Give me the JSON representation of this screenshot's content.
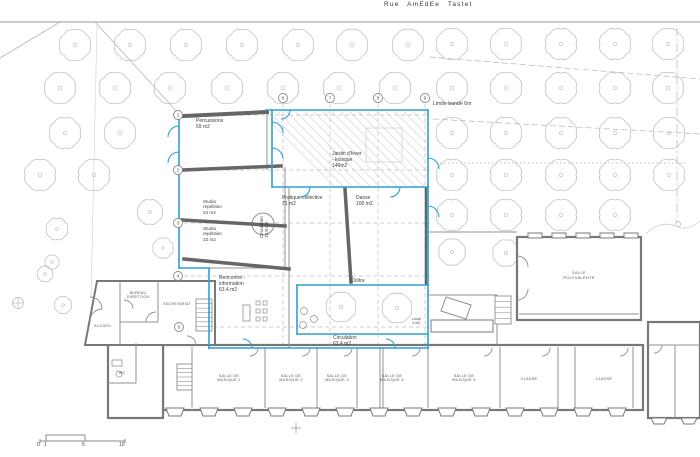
{
  "street": {
    "label": "Rue AmEdEe Tastet"
  },
  "colors": {
    "blue": "#2e9fd6",
    "wall": "#666666",
    "bldg": "#787878",
    "inner": "#909090",
    "door": "#8f8f8f",
    "thin": "#b5b5b5",
    "faint": "#d0d0d0",
    "road": "#9a9a9a",
    "dash": "#bdbdbd",
    "tree": "#c3c9c9",
    "text": "#3e3e3e",
    "marker": "#8a8a8a"
  },
  "labels": [
    {
      "name": "street-name",
      "text": "Rue AmEdEe Tastet",
      "x": 384,
      "y": 1,
      "size": 6.5,
      "cls": "street"
    },
    {
      "name": "limite-label",
      "text": "Limite bande 6m",
      "x": 433,
      "y": 101,
      "size": 5.2,
      "cls": ""
    },
    {
      "name": "room-percussions",
      "text": "Percussions\n59 m2",
      "x": 196,
      "y": 119,
      "size": 5,
      "cls": ""
    },
    {
      "name": "room-jardin-hiver",
      "text": "Jardin d'hiver\n- kiosque\n146m2",
      "x": 332,
      "y": 152,
      "size": 5,
      "cls": ""
    },
    {
      "name": "room-pratique-collective",
      "text": "Pratique collective\n71 m2",
      "x": 282,
      "y": 196,
      "size": 5,
      "cls": ""
    },
    {
      "name": "room-danse",
      "text": "Danse\n100 m2",
      "x": 356,
      "y": 196,
      "size": 5,
      "cls": ""
    },
    {
      "name": "room-studio-1",
      "text": "Studio\nrépétition\n23 m2",
      "x": 203,
      "y": 199,
      "size": 4.6,
      "cls": ""
    },
    {
      "name": "room-studio-2",
      "text": "Studio\nrépétition\n23 m2",
      "x": 203,
      "y": 226,
      "size": 4.6,
      "cls": ""
    },
    {
      "name": "room-circulation-vertical",
      "text": "Circulation\n13.8 m2",
      "x": 259,
      "y": 238,
      "size": 4.6,
      "cls": "vert"
    },
    {
      "name": "room-rencontre",
      "text": "Rencontre -\ninformation\n63.4 m2",
      "x": 219,
      "y": 276,
      "size": 5,
      "cls": ""
    },
    {
      "name": "room-cloitre",
      "text": "Cloître",
      "x": 350,
      "y": 279,
      "size": 5,
      "cls": ""
    },
    {
      "name": "room-circulation-bas",
      "text": "Circulation\n63.4 m2",
      "x": 333,
      "y": 336,
      "size": 5,
      "cls": ""
    },
    {
      "name": "room-bureau-direction",
      "text": "BUREAU\nDIRECTION",
      "x": 138,
      "y": 291,
      "size": 3.6,
      "cls": "caps center"
    },
    {
      "name": "room-secretariat",
      "text": "SECRETARIAT",
      "x": 177,
      "y": 302,
      "size": 3.6,
      "cls": "caps center"
    },
    {
      "name": "room-accueil",
      "text": "ACCUEIL",
      "x": 103,
      "y": 324,
      "size": 3.6,
      "cls": "caps center"
    },
    {
      "name": "room-wc",
      "text": "WC",
      "x": 122,
      "y": 371,
      "size": 3.6,
      "cls": "caps center"
    },
    {
      "name": "room-salle-polyvalente",
      "text": "SALLE\nPOLYVALENTE",
      "x": 579,
      "y": 271,
      "size": 4,
      "cls": "caps center"
    },
    {
      "name": "room-salle-musique-1",
      "text": "SALLE DE\nMUSIQUE 1",
      "x": 229,
      "y": 374,
      "size": 3.8,
      "cls": "caps center"
    },
    {
      "name": "room-salle-musique-2",
      "text": "SALLE DE\nMUSIQUE 2",
      "x": 291,
      "y": 374,
      "size": 3.8,
      "cls": "caps center"
    },
    {
      "name": "room-salle-musique-3",
      "text": "SALLE DE\nMUSIQUE 3",
      "x": 337,
      "y": 374,
      "size": 3.8,
      "cls": "caps center"
    },
    {
      "name": "room-salle-musique-4",
      "text": "SALLE DE\nMUSIQUE 4",
      "x": 392,
      "y": 374,
      "size": 3.8,
      "cls": "caps center"
    },
    {
      "name": "room-salle-musique-5",
      "text": "SALLE DE\nMUSIQUE 5",
      "x": 464,
      "y": 374,
      "size": 3.8,
      "cls": "caps center"
    },
    {
      "name": "room-classe-1",
      "text": "CLASSE",
      "x": 529,
      "y": 377,
      "size": 3.8,
      "cls": "caps center"
    },
    {
      "name": "room-classe-2",
      "text": "CLASSE",
      "x": 604,
      "y": 377,
      "size": 3.8,
      "cls": "caps center"
    },
    {
      "name": "room-local",
      "text": "Local\n4 m2",
      "x": 412,
      "y": 317,
      "size": 3.6,
      "cls": ""
    },
    {
      "name": "scale-0",
      "text": "0",
      "x": 37,
      "y": 443,
      "size": 5,
      "cls": ""
    },
    {
      "name": "scale-1",
      "text": "1",
      "x": 44,
      "y": 443,
      "size": 5,
      "cls": ""
    },
    {
      "name": "scale-5",
      "text": "5",
      "x": 82,
      "y": 443,
      "size": 5,
      "cls": ""
    },
    {
      "name": "scale-10",
      "text": "10",
      "x": 119,
      "y": 443,
      "size": 5,
      "cls": ""
    }
  ],
  "grid_markers": [
    {
      "n": "1",
      "x": 178,
      "y": 115
    },
    {
      "n": "2",
      "x": 178,
      "y": 170
    },
    {
      "n": "3",
      "x": 178,
      "y": 223
    },
    {
      "n": "4",
      "x": 178,
      "y": 276
    },
    {
      "n": "5",
      "x": 179,
      "y": 327
    },
    {
      "n": "6",
      "x": 283,
      "y": 98
    },
    {
      "n": "7",
      "x": 330,
      "y": 98
    },
    {
      "n": "8",
      "x": 378,
      "y": 98
    },
    {
      "n": "9",
      "x": 425,
      "y": 98
    }
  ],
  "trees": [
    [
      75,
      45
    ],
    [
      130,
      45
    ],
    [
      186,
      45
    ],
    [
      242,
      45
    ],
    [
      298,
      45
    ],
    [
      352,
      45
    ],
    [
      408,
      45
    ],
    [
      452,
      44
    ],
    [
      506,
      44
    ],
    [
      561,
      44
    ],
    [
      615,
      44
    ],
    [
      668,
      44
    ],
    [
      60,
      88
    ],
    [
      115,
      88
    ],
    [
      170,
      88
    ],
    [
      227,
      88
    ],
    [
      283,
      88
    ],
    [
      339,
      88
    ],
    [
      395,
      88
    ],
    [
      452,
      88
    ],
    [
      506,
      88
    ],
    [
      561,
      88
    ],
    [
      615,
      88
    ],
    [
      668,
      88
    ],
    [
      65,
      133
    ],
    [
      120,
      133
    ],
    [
      452,
      133
    ],
    [
      506,
      133
    ],
    [
      561,
      133
    ],
    [
      615,
      133
    ],
    [
      669,
      133
    ],
    [
      40,
      175
    ],
    [
      94,
      175
    ],
    [
      452,
      175
    ],
    [
      506,
      175
    ],
    [
      561,
      175
    ],
    [
      615,
      175
    ],
    [
      669,
      175
    ],
    [
      452,
      215
    ],
    [
      506,
      215
    ],
    [
      561,
      215
    ],
    [
      615,
      215
    ],
    [
      150,
      212,
      16
    ],
    [
      57,
      229,
      14
    ],
    [
      163,
      248,
      13
    ],
    [
      45,
      274,
      10
    ],
    [
      341,
      307,
      19
    ],
    [
      397,
      308,
      19
    ],
    [
      452,
      252,
      17
    ],
    [
      506,
      253,
      17
    ],
    [
      52,
      262,
      9
    ],
    [
      63,
      305,
      11
    ]
  ],
  "geometry": {
    "lines": [
      [
        0,
        22,
        700,
        22,
        0.9,
        "road",
        ""
      ],
      [
        95,
        22,
        179,
        114,
        0.8,
        "thin",
        ""
      ],
      [
        60,
        22,
        0,
        58,
        0.8,
        "thin",
        ""
      ],
      [
        97,
        24,
        91,
        298,
        0.6,
        "faint",
        ""
      ],
      [
        430,
        57,
        700,
        79,
        0.7,
        "thin",
        "6 3"
      ],
      [
        433,
        119,
        700,
        134,
        0.7,
        "thin",
        "6 3"
      ],
      [
        440,
        163,
        688,
        163,
        1,
        "dash",
        "1.5 2.5"
      ],
      [
        677,
        28,
        677,
        222,
        0.7,
        "thin",
        "8 3 2 3"
      ],
      [
        184,
        115,
        430,
        115,
        0.7,
        "dash",
        "4 3"
      ],
      [
        184,
        170,
        430,
        170,
        0.7,
        "dash",
        "4 3"
      ],
      [
        184,
        223,
        430,
        223,
        0.7,
        "dash",
        "4 3"
      ],
      [
        184,
        276,
        430,
        276,
        0.7,
        "dash",
        "4 3"
      ],
      [
        185,
        327,
        430,
        327,
        0.7,
        "dash",
        "4 3"
      ],
      [
        283,
        104,
        283,
        352,
        0.7,
        "dash",
        "4 3"
      ],
      [
        330,
        104,
        330,
        352,
        0.7,
        "dash",
        "4 3"
      ],
      [
        378,
        104,
        378,
        352,
        0.7,
        "dash",
        "4 3"
      ],
      [
        425,
        104,
        425,
        352,
        0.7,
        "dash",
        "4 3"
      ],
      [
        12,
        303,
        24,
        303,
        0.6,
        "thin",
        ""
      ],
      [
        18,
        297,
        18,
        309,
        0.6,
        "thin",
        ""
      ],
      [
        291,
        428,
        301,
        428,
        0.8,
        "road",
        ""
      ],
      [
        296,
        423,
        296,
        433,
        0.8,
        "road",
        ""
      ],
      [
        40,
        441,
        125,
        441,
        1,
        "marker",
        ""
      ],
      [
        40,
        439,
        40,
        443,
        1,
        "marker",
        ""
      ],
      [
        125,
        439,
        125,
        443,
        1,
        "marker",
        ""
      ]
    ],
    "lines2": [
      [
        192,
        347,
        192,
        408
      ],
      [
        265,
        347,
        265,
        408
      ],
      [
        317,
        347,
        317,
        408
      ],
      [
        357,
        347,
        357,
        408
      ],
      [
        380,
        347,
        380,
        408
      ],
      [
        383,
        347,
        383,
        408
      ],
      [
        428,
        347,
        428,
        408
      ],
      [
        500,
        347,
        500,
        408
      ],
      [
        558,
        347,
        558,
        408
      ],
      [
        575,
        347,
        575,
        408
      ],
      [
        633,
        347,
        633,
        408
      ],
      [
        120,
        281,
        120,
        345
      ],
      [
        158,
        281,
        158,
        322
      ],
      [
        120,
        322,
        158,
        322
      ],
      [
        136,
        343,
        136,
        383
      ],
      [
        108,
        383,
        136,
        383
      ],
      [
        648,
        345,
        700,
        345
      ],
      [
        675,
        345,
        675,
        418
      ],
      [
        519,
        314,
        639,
        314
      ],
      [
        428,
        295,
        497,
        295
      ],
      [
        497,
        295,
        497,
        345
      ],
      [
        428,
        232,
        517,
        232
      ],
      [
        431,
        326,
        493,
        326
      ],
      [
        267,
        113,
        267,
        170
      ],
      [
        285,
        167,
        285,
        269
      ],
      [
        289,
        188,
        289,
        348
      ],
      [
        209,
        268,
        289,
        268
      ]
    ],
    "brects": [
      [
        163,
        345,
        480,
        65
      ],
      [
        108,
        343,
        55,
        75
      ],
      [
        517,
        237,
        124,
        83
      ],
      [
        648,
        322,
        52,
        96
      ]
    ],
    "polys": [
      [
        "97,281 215,281 215,345 85,345",
        "bldg",
        2,
        1
      ],
      [
        "446,297 471,305 466,319 441,311",
        "inner",
        1,
        0
      ]
    ],
    "rects": [
      [
        366,
        128,
        36,
        34,
        "faint",
        0.8,
        0
      ],
      [
        431,
        320,
        62,
        12,
        "bldg",
        1,
        1
      ],
      [
        243,
        305,
        7,
        16,
        "door",
        0.8,
        0
      ],
      [
        256,
        301,
        4,
        4,
        "door",
        0.7,
        0
      ],
      [
        263,
        301,
        4,
        4,
        "door",
        0.7,
        0
      ],
      [
        256,
        309,
        4,
        4,
        "door",
        0.7,
        0
      ],
      [
        263,
        309,
        4,
        4,
        "door",
        0.7,
        0
      ],
      [
        256,
        317,
        4,
        4,
        "door",
        0.7,
        0
      ],
      [
        263,
        317,
        4,
        4,
        "door",
        0.7,
        0
      ],
      [
        112,
        360,
        10,
        6,
        "door",
        0.8,
        0
      ],
      [
        528,
        233,
        14,
        5,
        "bldg",
        1,
        1
      ],
      [
        552,
        233,
        14,
        5,
        "bldg",
        1,
        1
      ],
      [
        576,
        233,
        14,
        5,
        "bldg",
        1,
        1
      ],
      [
        600,
        233,
        14,
        5,
        "bldg",
        1,
        1
      ],
      [
        624,
        233,
        14,
        5,
        "bldg",
        1,
        1
      ]
    ],
    "circles": [
      [
        678,
        224,
        2.5,
        "thin",
        0.7,
        0
      ],
      [
        18,
        303,
        5.5,
        "thin",
        0.7,
        0
      ],
      [
        263,
        224,
        11,
        "inner",
        1,
        1
      ],
      [
        304,
        311,
        3.5,
        "door",
        0.7,
        0
      ],
      [
        314,
        319,
        3.5,
        "door",
        0.7,
        0
      ],
      [
        303,
        325,
        3.5,
        "door",
        0.7,
        0
      ],
      [
        119,
        374,
        3,
        "door",
        0.7,
        0
      ]
    ],
    "stairs": [
      [
        196,
        299,
        16,
        32,
        7
      ],
      [
        177,
        364,
        15,
        26,
        6
      ],
      [
        495,
        296,
        16,
        28,
        5
      ]
    ],
    "buttresses": [
      {
        "y": 408,
        "h": 8,
        "hw": 9,
        "xs": [
          175,
          209,
          243,
          277,
          311,
          345,
          379,
          413,
          447,
          481,
          515,
          549,
          583,
          617
        ]
      },
      {
        "y": 418,
        "h": 6,
        "hw": 8,
        "xs": [
          659,
          689
        ]
      }
    ],
    "walls": [
      [
        184,
        116,
        267,
        112,
        4
      ],
      [
        182,
        170,
        281,
        166,
        3.5
      ],
      [
        182,
        220,
        285,
        226,
        3.5
      ],
      [
        184,
        259,
        289,
        269,
        3.5
      ],
      [
        345,
        189,
        351,
        282,
        3.5
      ],
      [
        426,
        188,
        426,
        284,
        2.5
      ]
    ],
    "blue_lines": [
      [
        179,
        112,
        179,
        268
      ],
      [
        266,
        110,
        428,
        110
      ],
      [
        428,
        110,
        428,
        348
      ],
      [
        272,
        110,
        272,
        187
      ],
      [
        272,
        187,
        428,
        187
      ],
      [
        297,
        285,
        428,
        285
      ],
      [
        297,
        285,
        297,
        334
      ],
      [
        297,
        334,
        428,
        334
      ],
      [
        209,
        268,
        209,
        348
      ],
      [
        209,
        348,
        428,
        348
      ],
      [
        179,
        268,
        209,
        268
      ]
    ],
    "paths": [
      [
        "M646,234 Q660,220 676,226 Q688,232 700,221",
        "faint",
        0.8,
        ""
      ],
      [
        "M46,441 L46,435 L85,435 L85,441",
        "marker",
        1,
        ""
      ],
      [
        "M258,348 a8,8 0 0 1 -8,8",
        "door",
        0.9,
        ""
      ],
      [
        "M310,348 a8,8 0 0 1 -8,8",
        "door",
        0.9,
        ""
      ],
      [
        "M352,348 a8,8 0 0 1 -8,8",
        "door",
        0.9,
        ""
      ],
      [
        "M420,348 a8,8 0 0 1 -8,8",
        "door",
        0.9,
        ""
      ],
      [
        "M492,348 a8,8 0 0 1 -8,8",
        "door",
        0.9,
        ""
      ],
      [
        "M550,348 a8,8 0 0 1 -8,8",
        "door",
        0.9,
        ""
      ],
      [
        "M628,348 a8,8 0 0 1 -8,8",
        "door",
        0.9,
        ""
      ],
      [
        "M662,345 a8,8 0 0 1 -8,8",
        "door",
        0.9,
        ""
      ],
      [
        "M146,322 a10,10 0 0 1 10,-10",
        "door",
        0.9,
        ""
      ],
      [
        "M124,300 a9,9 0 0 1 9,9",
        "door",
        0.9,
        ""
      ],
      [
        "M90,297 a12,12 0 0 1 12,12",
        "door",
        0.9,
        ""
      ],
      [
        "M102,309 a12,12 0 0 0 -12,12",
        "door",
        0.9,
        ""
      ],
      [
        "M517,256 a11,11 0 0 1 11,11",
        "door",
        0.9,
        ""
      ],
      [
        "M517,300 a11,11 0 0 0 11,-11",
        "door",
        0.9,
        ""
      ],
      [
        "M196,345 a9,9 0 0 0 -9,-9",
        "door",
        0.9,
        ""
      ],
      [
        "M179,126 a11,11 0 0 0 -11,11",
        "blue",
        1.1,
        ""
      ],
      [
        "M179,152 a11,11 0 0 0 -11,11",
        "blue",
        1.1,
        ""
      ],
      [
        "M272,122 a11,11 0 0 1 11,11",
        "blue",
        1.1,
        ""
      ],
      [
        "M272,148 a11,11 0 0 1 11,11",
        "blue",
        1.1,
        ""
      ],
      [
        "M310,187 a10,10 0 0 1 -10,10",
        "blue",
        1.1,
        ""
      ],
      [
        "M400,187 a10,10 0 0 1 -10,10",
        "blue",
        1.1,
        ""
      ],
      [
        "M428,158 a11,11 0 0 1 11,11",
        "blue",
        1.1,
        ""
      ],
      [
        "M428,206 a11,11 0 0 1 11,11",
        "blue",
        1.1,
        ""
      ],
      [
        "M252,348 a9,9 0 0 0 -9,-9",
        "blue",
        1.1,
        ""
      ],
      [
        "M395,348 a9,9 0 0 0 -9,-9",
        "blue",
        1.1,
        ""
      ],
      [
        "M290,110 a9,9 0 0 1 -9,9",
        "blue",
        1.1,
        ""
      ]
    ],
    "hatch": {
      "x": 273,
      "y": 112,
      "w": 153,
      "h": 74,
      "step": 9,
      "count": 18
    }
  }
}
